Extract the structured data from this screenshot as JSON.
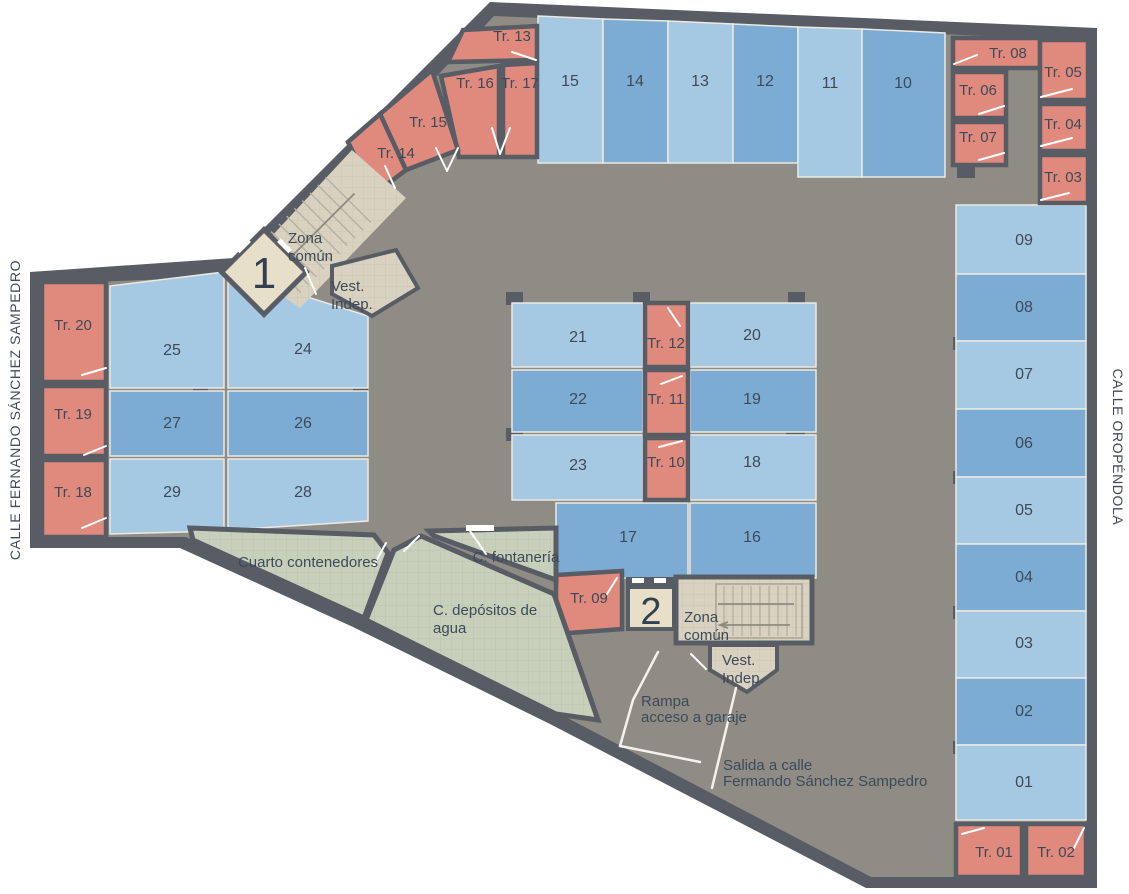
{
  "streets": {
    "left": "CALLE FERNANDO SÁNCHEZ SAMPEDRO",
    "right": "CALLE OROPÉNDOLA"
  },
  "parking": {
    "p01": "01",
    "p02": "02",
    "p03": "03",
    "p04": "04",
    "p05": "05",
    "p06": "06",
    "p07": "07",
    "p08": "08",
    "p09": "09",
    "p10": "10",
    "p11": "11",
    "p12": "12",
    "p13": "13",
    "p14": "14",
    "p15": "15",
    "p16": "16",
    "p17": "17",
    "p18": "18",
    "p19": "19",
    "p20": "20",
    "p21": "21",
    "p22": "22",
    "p23": "23",
    "p24": "24",
    "p25": "25",
    "p26": "26",
    "p27": "27",
    "p28": "28",
    "p29": "29"
  },
  "storage": {
    "tr01": "Tr. 01",
    "tr02": "Tr. 02",
    "tr03": "Tr. 03",
    "tr04": "Tr. 04",
    "tr05": "Tr. 05",
    "tr06": "Tr. 06",
    "tr07": "Tr. 07",
    "tr08": "Tr. 08",
    "tr09": "Tr. 09",
    "tr10": "Tr. 10",
    "tr11": "Tr. 11",
    "tr12": "Tr. 12",
    "tr13": "Tr. 13",
    "tr14": "Tr. 14",
    "tr15": "Tr. 15",
    "tr16": "Tr. 16",
    "tr17": "Tr. 17",
    "tr18": "Tr. 18",
    "tr19": "Tr. 19",
    "tr20": "Tr. 20"
  },
  "cores": {
    "elevator1": "1",
    "elevator2": "2",
    "zona1_lines": [
      "Zona",
      "común"
    ],
    "zona2_lines": [
      "Zona",
      "común"
    ],
    "vest1_lines": [
      "Vest.",
      "Indep."
    ],
    "vest2_lines": [
      "Vest.",
      "Indep."
    ]
  },
  "technical": {
    "contenedores": "Cuarto contenedores",
    "depositos_lines": [
      "C. depósitos de",
      "agua"
    ],
    "fontaneria": "C. fontanería"
  },
  "annotations": {
    "rampa_lines": [
      "Rampa",
      "acceso a garaje"
    ],
    "salida_lines": [
      "Salida a calle",
      "Fermando Sánchez Sampedro"
    ]
  },
  "colors": {
    "parking_light": "#a5c8e3",
    "parking_dark": "#7cacd3",
    "storage": "#e08a7d",
    "technical": "#c8cfba",
    "core": "#d9d2c0",
    "elevator": "#e8dfc9",
    "floor": "#8f8b85",
    "wall": "#585c64"
  }
}
